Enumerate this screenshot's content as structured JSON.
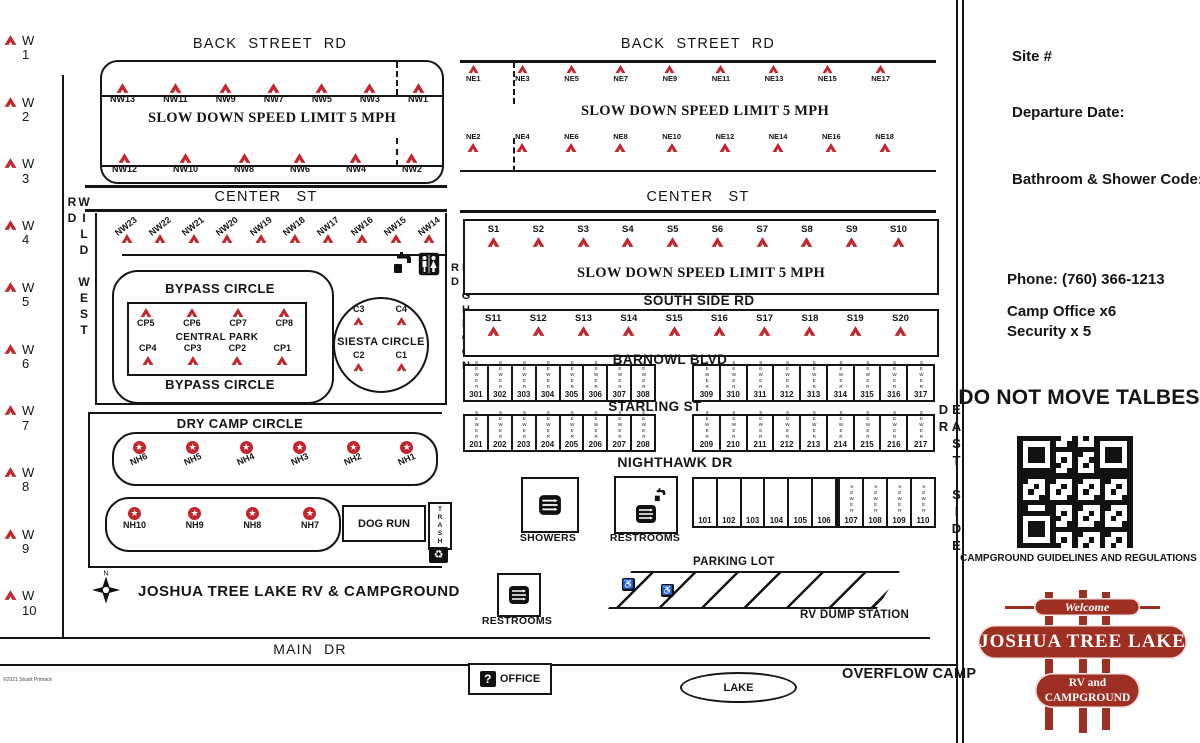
{
  "colors": {
    "tent_red": "#c1272d",
    "brand_red": "#9e2f23",
    "ink": "#151515"
  },
  "roads": {
    "back_street": "BACK STREET RD",
    "center_st": "CENTER ST",
    "wild_west": "WILD WEST RD",
    "highnoon": "HIGHNOON RD",
    "east_side": "EAST SIDE DR",
    "south_side": "SOUTH SIDE RD",
    "barnowl": "BARNOWL BLVD",
    "starling": "STARLING ST",
    "nighthawk": "NIGHTHAWK DR",
    "main_dr": "MAIN DR",
    "bypass": "BYPASS CIRCLE",
    "dry_camp": "DRY CAMP CIRCLE",
    "siesta": "SIESTA CIRCLE",
    "central_park": "CENTRAL PARK"
  },
  "speed_limit": "SLOW DOWN SPEED LIMIT 5 MPH",
  "sites": {
    "west": [
      "W 1",
      "W 2",
      "W 3",
      "W 4",
      "W 5",
      "W 6",
      "W 7",
      "W 8",
      "W 9",
      "W 10"
    ],
    "nw_top": [
      "NW13",
      "NW11",
      "NW9",
      "NW7",
      "NW5",
      "NW3",
      "NW1"
    ],
    "nw_bottom": [
      "NW12",
      "NW10",
      "NW8",
      "NW6",
      "NW4",
      "NW2"
    ],
    "nw_center": [
      "NW23",
      "NW22",
      "NW21",
      "NW20",
      "NW19",
      "NW18",
      "NW17",
      "NW16",
      "NW15",
      "NW14"
    ],
    "ne_top": [
      "NE1",
      "NE3",
      "NE5",
      "NE7",
      "NE9",
      "NE11",
      "NE13",
      "NE15",
      "NE17"
    ],
    "ne_bottom": [
      "NE2",
      "NE4",
      "NE6",
      "NE8",
      "NE10",
      "NE12",
      "NE14",
      "NE16",
      "NE18"
    ],
    "s_row1": [
      "S1",
      "S2",
      "S3",
      "S4",
      "S5",
      "S6",
      "S7",
      "S8",
      "S9",
      "S10"
    ],
    "s_row2": [
      "S11",
      "S12",
      "S13",
      "S14",
      "S15",
      "S16",
      "S17",
      "S18",
      "S19",
      "S20"
    ],
    "cp_top": [
      "CP5",
      "CP6",
      "CP7",
      "CP8"
    ],
    "cp_bottom": [
      "CP4",
      "CP3",
      "CP2",
      "CP1"
    ],
    "c_top": [
      "C3",
      "C4"
    ],
    "c_bottom": [
      "C2",
      "C1"
    ],
    "nh_top": [
      "NH6",
      "NH5",
      "NH4",
      "NH3",
      "NH2",
      "NH1"
    ],
    "nh_bottom": [
      "NH10",
      "NH9",
      "NH8",
      "NH7"
    ],
    "sewer_301": [
      "301",
      "302",
      "303",
      "304",
      "305",
      "306",
      "307",
      "308"
    ],
    "sewer_309": [
      "309",
      "310",
      "311",
      "312",
      "313",
      "314",
      "315",
      "316",
      "317"
    ],
    "sewer_201": [
      "201",
      "202",
      "203",
      "204",
      "205",
      "206",
      "207",
      "208"
    ],
    "sewer_209": [
      "209",
      "210",
      "211",
      "212",
      "213",
      "214",
      "215",
      "216",
      "217"
    ],
    "plain_101": [
      "101",
      "102",
      "103",
      "104",
      "105",
      "106"
    ],
    "sewer_107": [
      "107",
      "108",
      "109",
      "110"
    ],
    "sewer_label": "SEWER"
  },
  "facilities": {
    "showers": "SHOWERS",
    "restrooms": "RESTROOMS",
    "dog_run": "DOG RUN",
    "trash": "TRASH",
    "office": "OFFICE",
    "lake": "LAKE",
    "parking": "PARKING LOT",
    "rv_dump": "RV DUMP STATION",
    "overflow": "OVERFLOW CAMP"
  },
  "map_title": "JOSHUA TREE LAKE RV & CAMPGROUND",
  "compass_n": "N",
  "copyright": "©2021 Stuart Primack",
  "sidebar": {
    "site_label": "Site #",
    "departure_label": "Departure Date:",
    "code_label": "Bathroom & Shower Code:",
    "phone": "Phone: (760) 366-1213",
    "camp_office": "Camp Office x6",
    "security": "Security x 5",
    "notice": "DO NOT MOVE TALBES",
    "qr_caption": "CAMPGROUND GUIDELINES AND REGULATIONS",
    "logo": {
      "welcome": "Welcome",
      "line1": "JOSHUA TREE LAKE",
      "line2": "RV and",
      "line3": "CAMPGROUND"
    }
  }
}
